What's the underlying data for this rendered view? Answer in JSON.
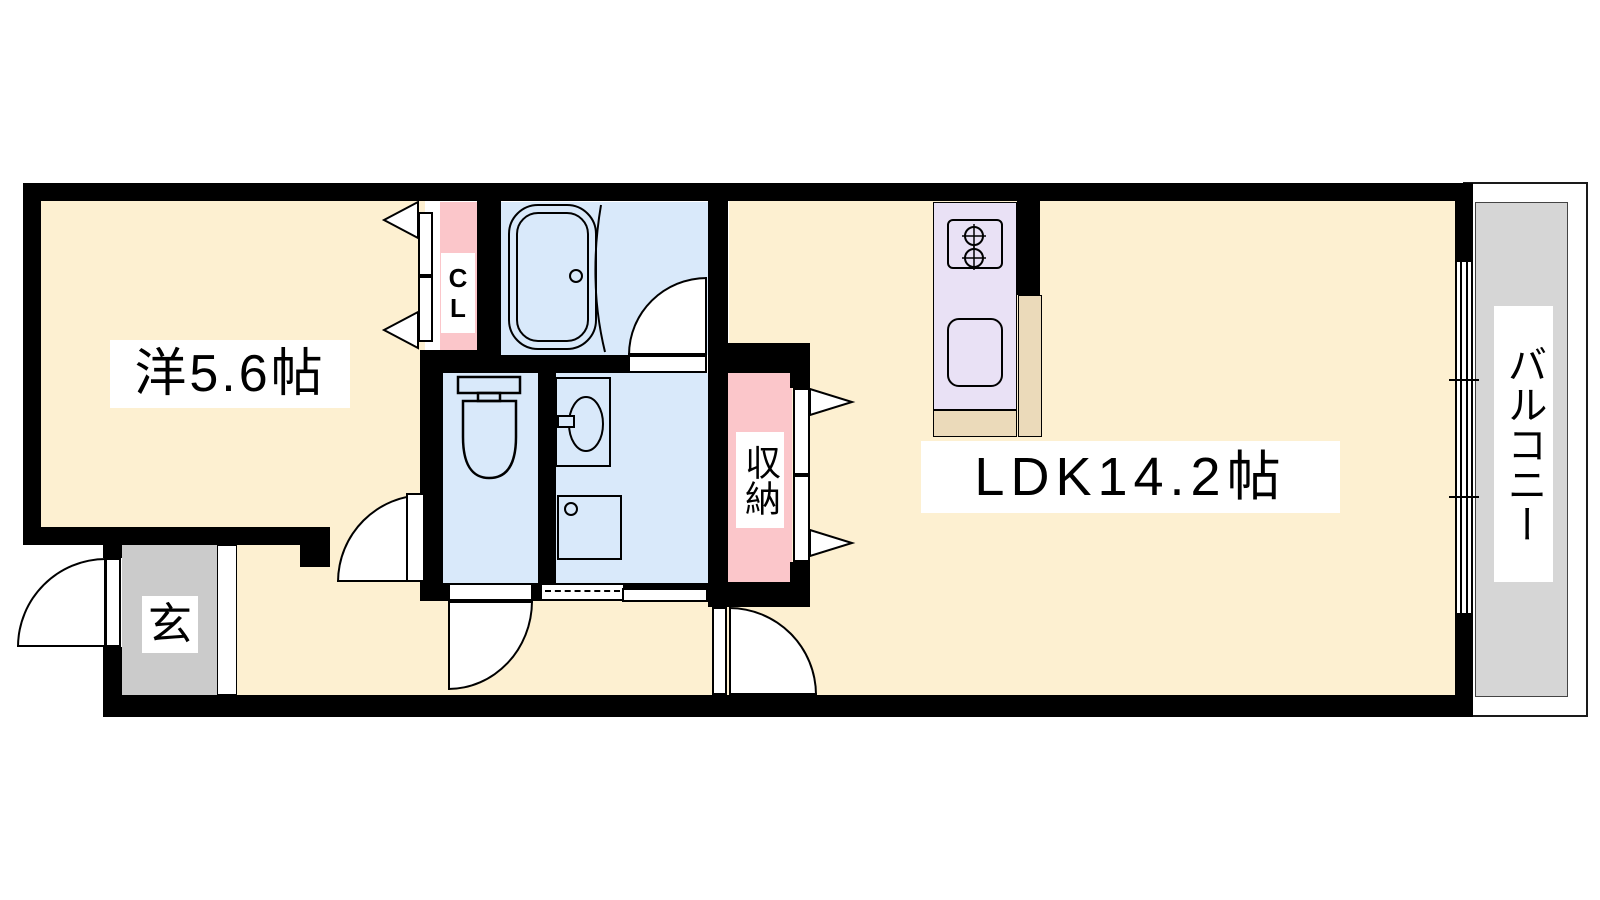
{
  "floorplan": {
    "labels": {
      "western_room": "洋5.6帖",
      "ldk": "LDK14.2帖",
      "closet": "CL",
      "storage": "収納",
      "balcony": "バルコニー",
      "entrance": "玄"
    },
    "colors": {
      "room_floor": "#fdf0d1",
      "wet_area_floor": "#d9e9fa",
      "closet_storage_fill": "#fbc6ca",
      "kitchen_unit_fill": "#e9e1f5",
      "kitchen_counter_fill": "#ebdaba",
      "entrance_floor": "#cbcbcb",
      "balcony_floor": "#d6d6d6",
      "wall": "#000000",
      "label_background": "#ffffff"
    }
  }
}
